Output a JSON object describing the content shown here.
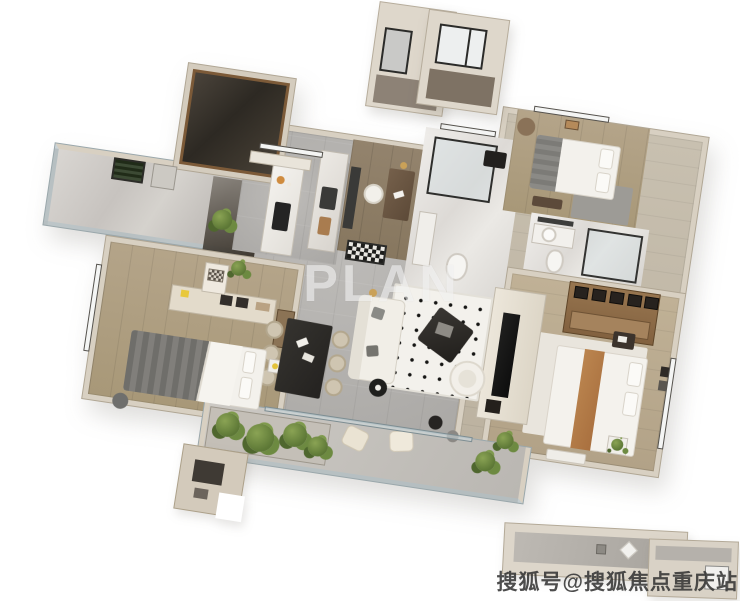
{
  "watermarks": {
    "center": "PLAN",
    "bottom_right": "搜狐号@搜狐焦点重庆站"
  },
  "palette": {
    "background": "#ffffff",
    "wall": "#d8d0c2",
    "wall_edge": "#b0a694",
    "floor_tile": "#b7b5b2",
    "floor_marble": "#cdc9c5",
    "floor_wood_dark": "#8f7f6a",
    "floor_wood_light": "#b9a98f",
    "dark_room": "#332e27",
    "cabinet_brown": "#8f6f4c",
    "dining_table_dark": "#2d2b28",
    "sofa_white": "#f1eee7",
    "bed_white": "#f3f1ec",
    "bed_gray": "#75746f",
    "bed_tan_runner": "#b07c52",
    "plant_green": "#6a8544",
    "tv_black": "#141414",
    "glass": "#d7e0e3"
  },
  "rooms": [
    {
      "name": "left-balcony"
    },
    {
      "name": "dark-cloakroom"
    },
    {
      "name": "kitchen"
    },
    {
      "name": "study"
    },
    {
      "name": "bathroom-main"
    },
    {
      "name": "bedroom-top-right"
    },
    {
      "name": "bathroom-ensuite"
    },
    {
      "name": "wardrobe-closet"
    },
    {
      "name": "master-bedroom"
    },
    {
      "name": "bedroom-left"
    },
    {
      "name": "dining-area"
    },
    {
      "name": "living-room"
    },
    {
      "name": "tv-wall"
    },
    {
      "name": "entry-hall"
    },
    {
      "name": "south-balcony"
    },
    {
      "name": "equipment-platform-north"
    },
    {
      "name": "equipment-platform-south"
    }
  ]
}
